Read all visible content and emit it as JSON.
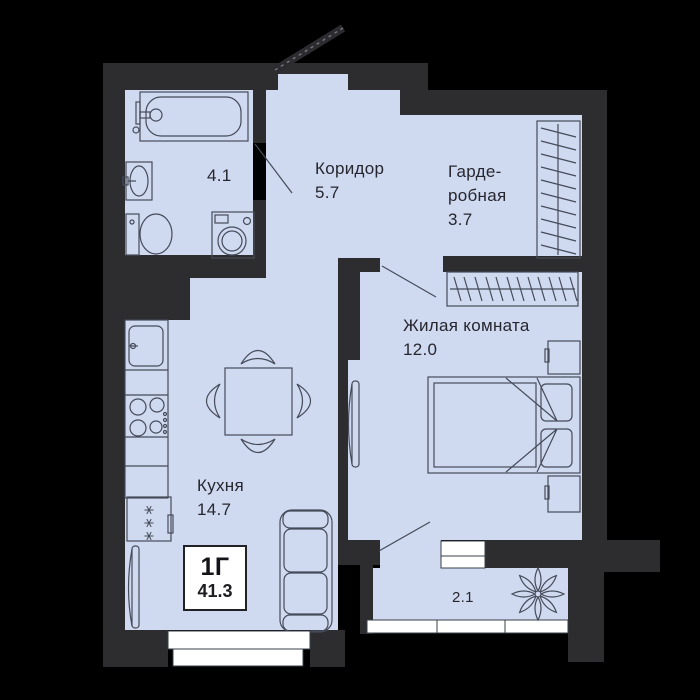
{
  "plan": {
    "unit": {
      "type": "1Г",
      "area": "41.3"
    },
    "rooms": [
      {
        "id": "bathroom",
        "area": "4.1"
      },
      {
        "id": "corridor",
        "name": "Коридор",
        "area": "5.7"
      },
      {
        "id": "wardrobe",
        "name_line1": "Гарде-",
        "name_line2": "робная",
        "area": "3.7"
      },
      {
        "id": "living-room",
        "name": "Жилая комната",
        "area": "12.0"
      },
      {
        "id": "kitchen",
        "name": "Кухня",
        "area": "14.7"
      },
      {
        "id": "balcony",
        "area": "2.1"
      }
    ],
    "colors": {
      "background": "#000000",
      "wall": "#2d2d30",
      "floor": "#cfd9f0",
      "outline": "#454b59",
      "window": "#ffffff",
      "text": "#26262e"
    }
  }
}
